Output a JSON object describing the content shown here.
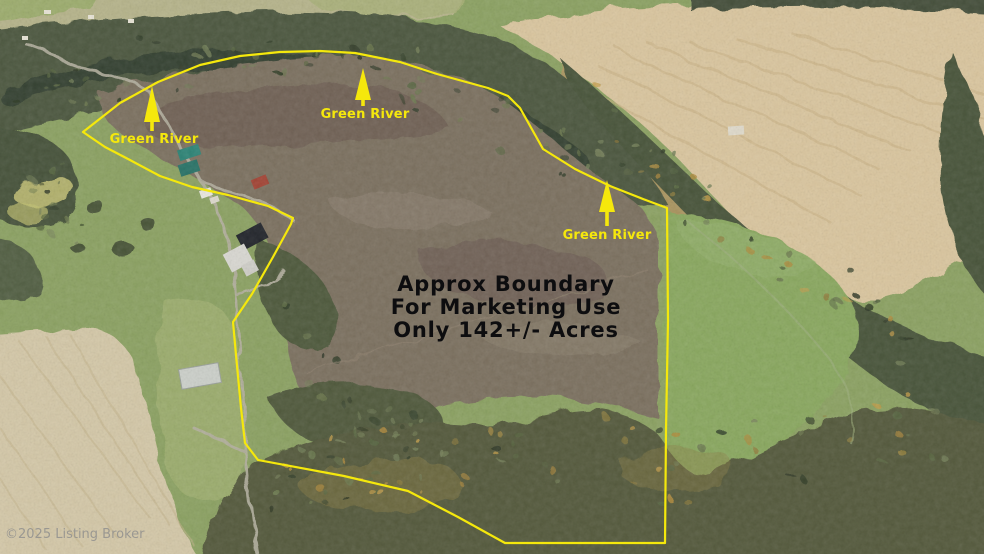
{
  "page": {
    "type": "aerial-property-listing-photo",
    "width": 984,
    "height": 554
  },
  "annotations": {
    "boundary_color": "#f5e80c",
    "label_color": "#f5e80c",
    "center_text_color": "#0d0d0f",
    "watermark_color": "#8d8d8d",
    "acreage": "142+/- Acres",
    "center_text": {
      "lines": [
        "Approx Boundary",
        "For Marketing Use",
        "Only 142+/- Acres"
      ],
      "x": 506,
      "baselines": [
        291,
        314,
        337
      ],
      "font_size": 21
    },
    "river_labels": [
      {
        "text": "Green River",
        "label_x": 154,
        "label_y": 143,
        "arrow_tip_x": 152,
        "arrow_tip_y": 86,
        "arrow_base_y": 122,
        "stem_bottom_y": 131
      },
      {
        "text": "Green River",
        "label_x": 365,
        "label_y": 118,
        "arrow_tip_x": 363,
        "arrow_tip_y": 68,
        "arrow_base_y": 100,
        "stem_bottom_y": 106
      },
      {
        "text": "Green River",
        "label_x": 607,
        "label_y": 239,
        "arrow_tip_x": 607,
        "arrow_tip_y": 180,
        "arrow_base_y": 212,
        "stem_bottom_y": 226
      }
    ],
    "watermark": {
      "text": "©2025 Listing Broker",
      "x": 5,
      "y": 538
    }
  },
  "boundary": {
    "closed": true,
    "stroke_width": 2.2,
    "points": [
      [
        83,
        132
      ],
      [
        120,
        103
      ],
      [
        158,
        82
      ],
      [
        200,
        65
      ],
      [
        240,
        56
      ],
      [
        280,
        52
      ],
      [
        320,
        51
      ],
      [
        355,
        53
      ],
      [
        400,
        62
      ],
      [
        437,
        74
      ],
      [
        488,
        88
      ],
      [
        508,
        96
      ],
      [
        520,
        108
      ],
      [
        543,
        149
      ],
      [
        575,
        169
      ],
      [
        610,
        186
      ],
      [
        643,
        199
      ],
      [
        667,
        208
      ],
      [
        668,
        320
      ],
      [
        666,
        430
      ],
      [
        665,
        543
      ],
      [
        505,
        543
      ],
      [
        458,
        517
      ],
      [
        408,
        491
      ],
      [
        344,
        476
      ],
      [
        258,
        460
      ],
      [
        245,
        443
      ],
      [
        241,
        408
      ],
      [
        236,
        355
      ],
      [
        233,
        322
      ],
      [
        252,
        294
      ],
      [
        273,
        257
      ],
      [
        291,
        224
      ],
      [
        293,
        218
      ],
      [
        268,
        206
      ],
      [
        228,
        195
      ],
      [
        192,
        187
      ],
      [
        160,
        176
      ],
      [
        130,
        160
      ],
      [
        105,
        147
      ]
    ]
  }
}
